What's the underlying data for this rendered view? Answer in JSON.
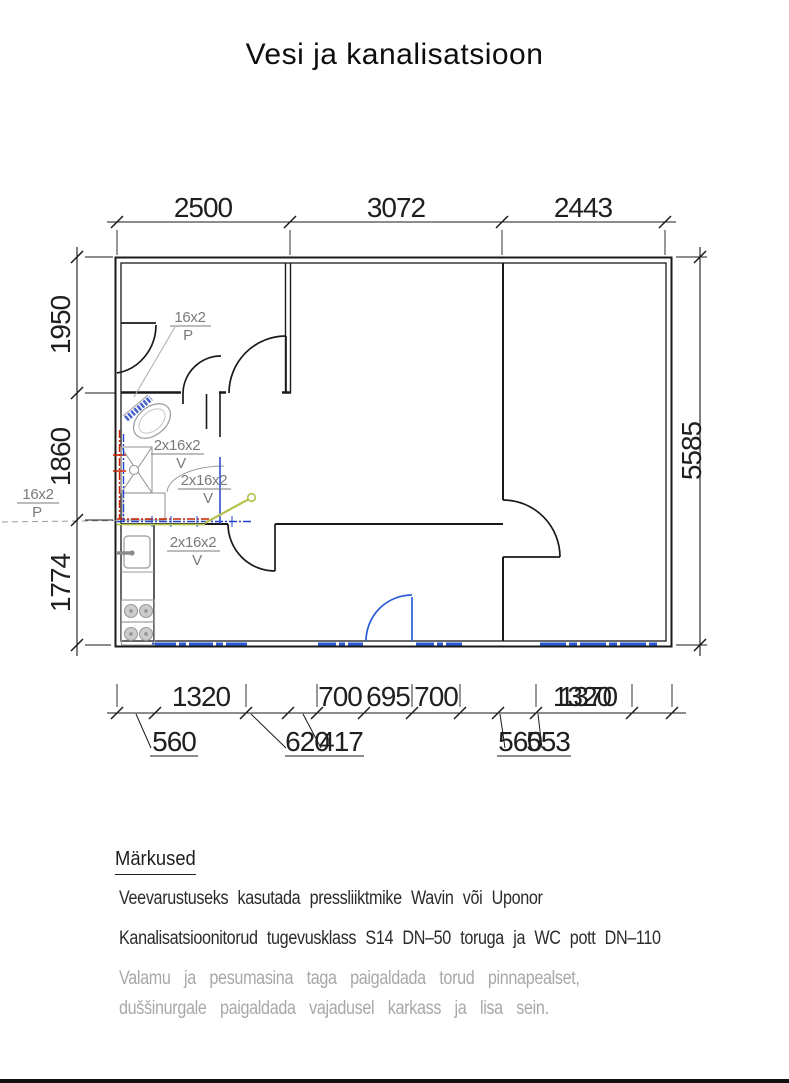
{
  "title": "Vesi ja kanalisatsioon",
  "plan": {
    "dim_top": [
      "2500",
      "3072",
      "2443"
    ],
    "dim_left": [
      "1950",
      "1860",
      "1774"
    ],
    "dim_right": "5585",
    "dim_bottom_row1": [
      "1320",
      "700",
      "695",
      "700"
    ],
    "dim_bottom_overlap": [
      "1370",
      "1320"
    ],
    "dim_bottom_row2": [
      "560",
      "620",
      "417",
      "560",
      "553"
    ],
    "pipe_labels": {
      "p1": {
        "text": "16x2",
        "sub": "P"
      },
      "p2": {
        "text": "16x2",
        "sub": "P"
      },
      "v1": {
        "text": "2x16x2",
        "sub": "V"
      },
      "v2": {
        "text": "2x16x2",
        "sub": "V"
      },
      "v3": {
        "text": "2x16x2",
        "sub": "V"
      }
    },
    "colors": {
      "wall": "#1a1a1a",
      "fixture": "#9a9a9a",
      "cold_water": "#2244cc",
      "hot_water": "#cc2200",
      "mixer": "#b5c24f",
      "entry_door": "#2a5bd7",
      "label": "#7a7a7a"
    }
  },
  "notes": {
    "heading": "Märkused",
    "items": [
      {
        "text": "Veevarustuseks kasutada pressliiktmike Wavin või Uponor",
        "muted": false
      },
      {
        "text": "Kanalisatsioonitorud tugevusklass S14 DN–50 toruga ja WC pott DN–110",
        "muted": false
      },
      {
        "text": "Valamu ja pesumasina taga paigaldada torud pinnapealset,",
        "muted": true
      },
      {
        "text": "duššinurgale paigaldada vajadusel karkass ja lisa sein.",
        "muted": true
      }
    ]
  }
}
